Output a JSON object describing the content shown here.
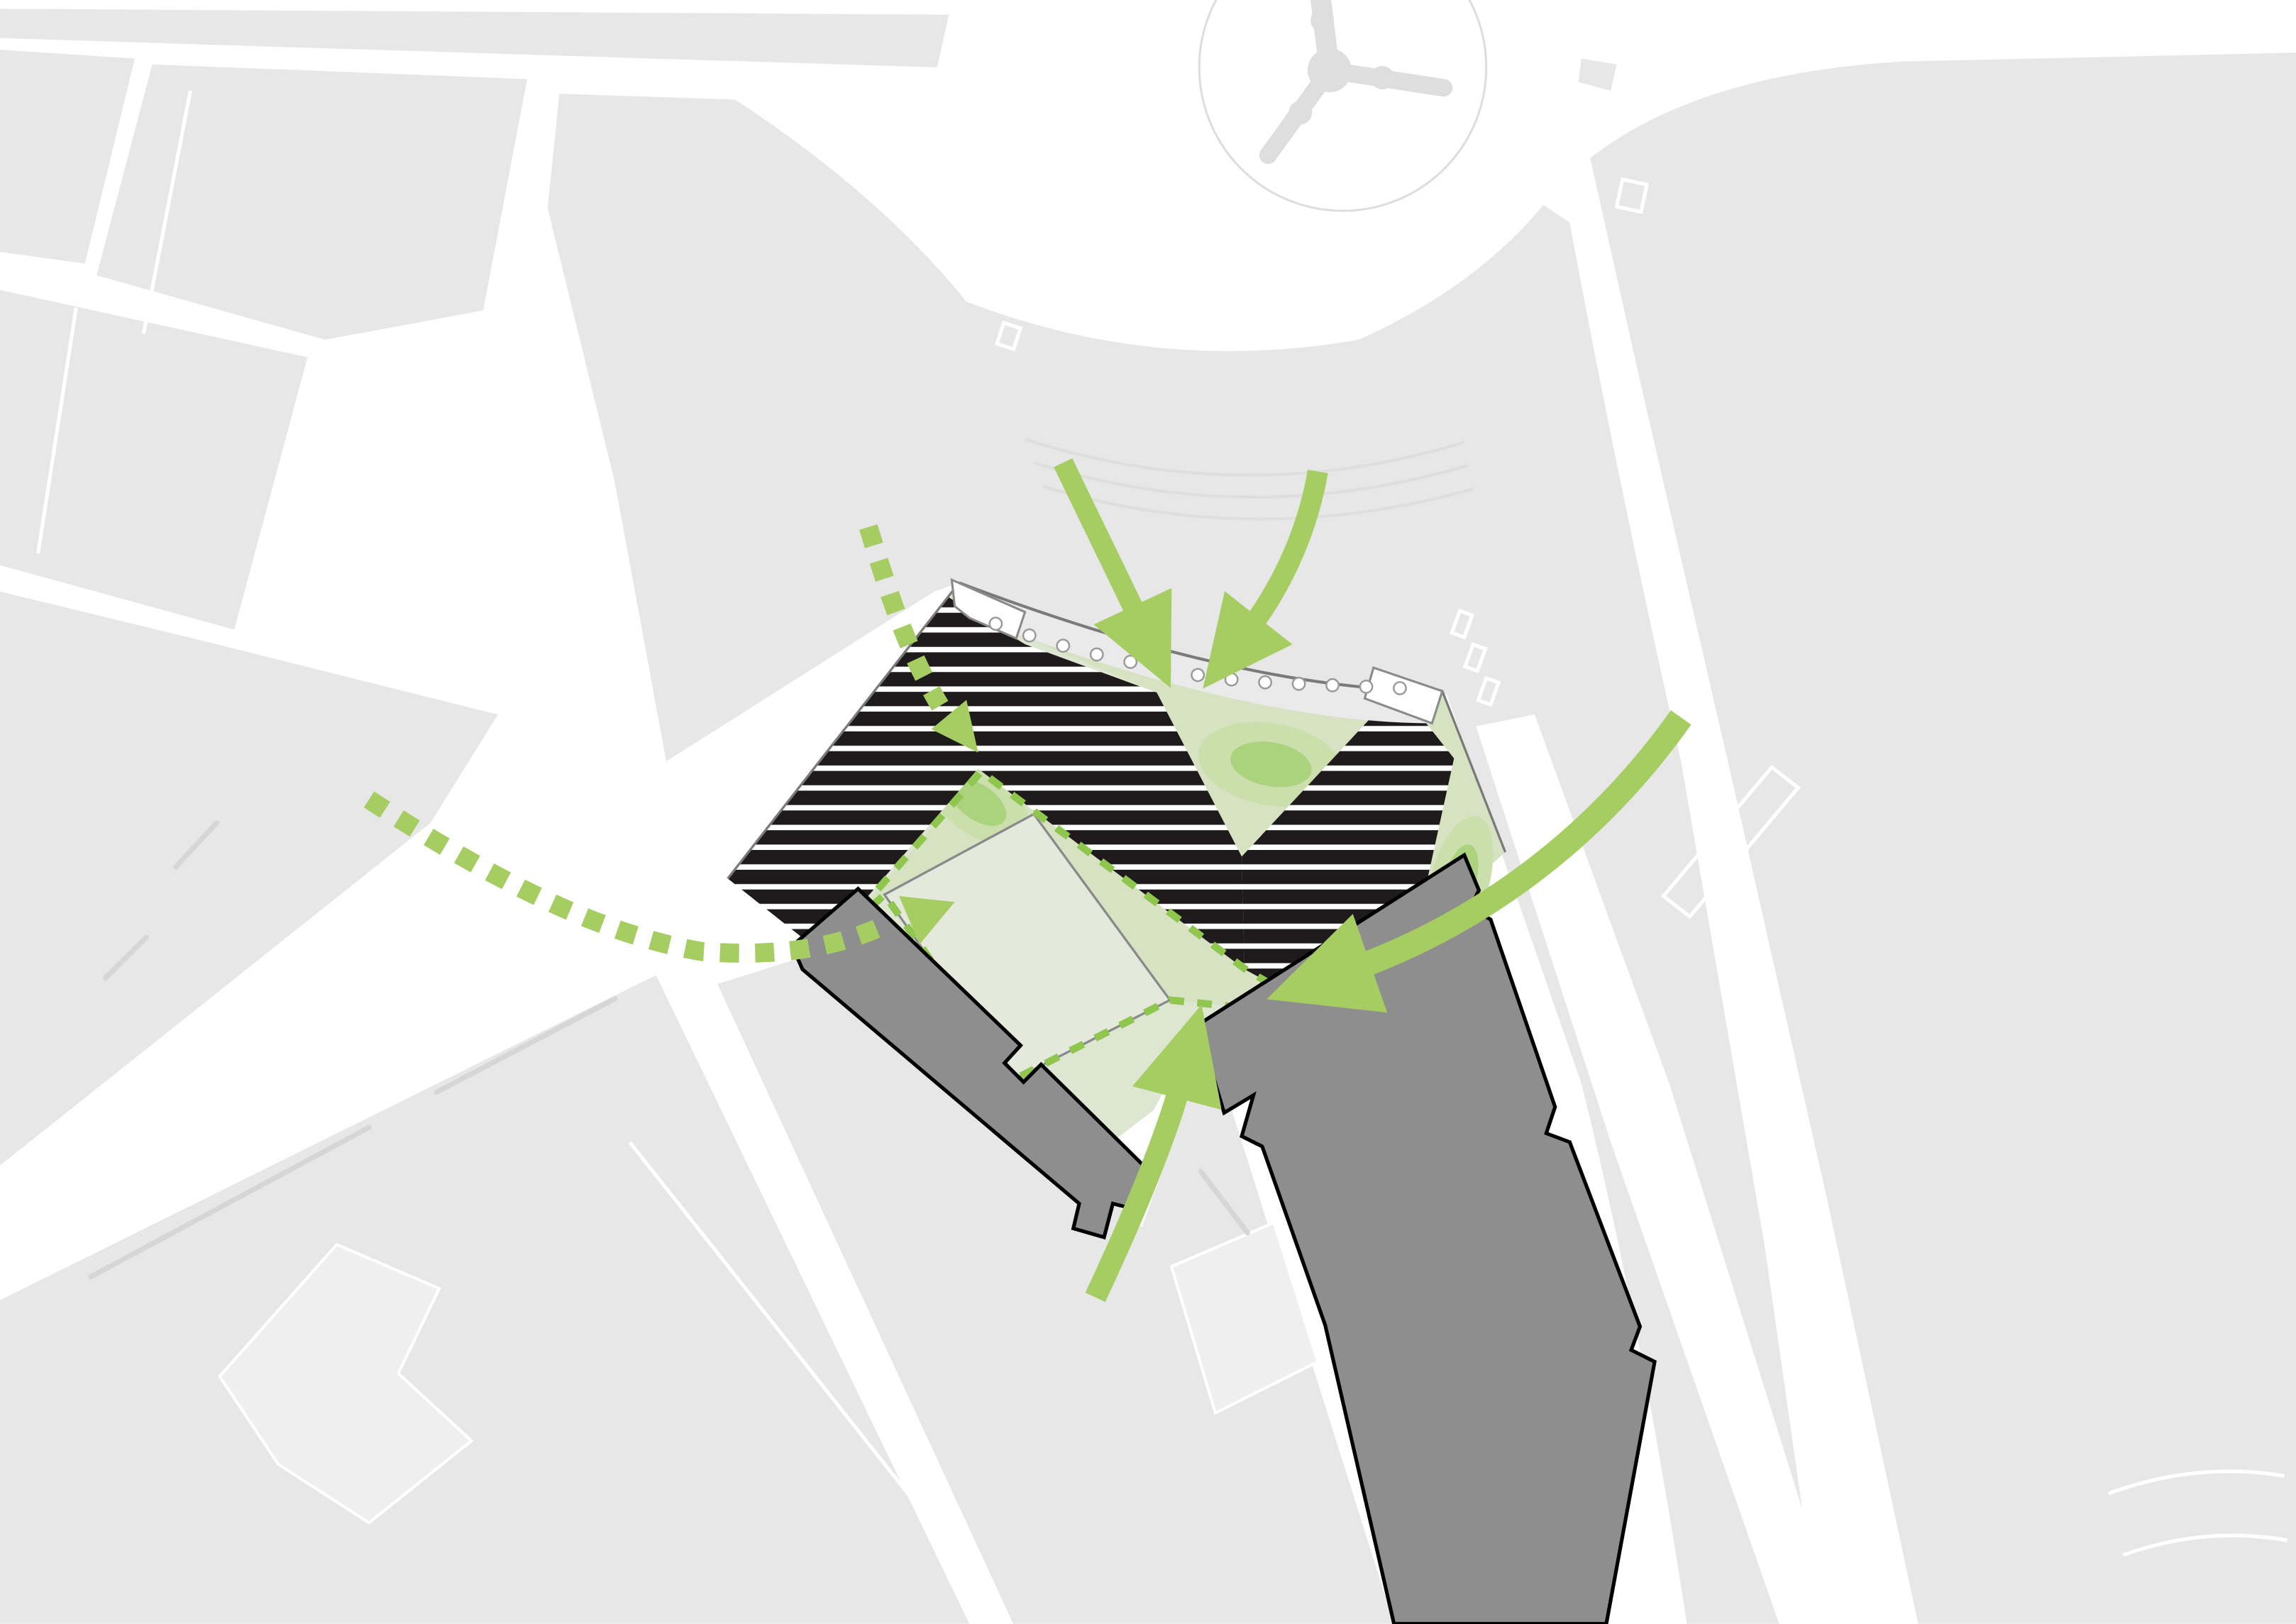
{
  "diagram": {
    "title": "Urban site plan access diagram",
    "type": "architectural-site-diagram",
    "has_visible_text": false,
    "colors": {
      "white": "#ffffff",
      "block": "#e7e7e7",
      "block-light": "#efefef",
      "lane": "#d6d6d6",
      "outline-faint": "#dedede",
      "boundary": "#7a7a7a",
      "site-green": "#dde6d0",
      "valley-green": "#d6e2c2",
      "mound1": "#cbdfad",
      "mound2": "#abd37e",
      "square": "#e4e9dc",
      "square-stroke": "#8a8a8a",
      "black": "#1f1b1c",
      "bldg-gray": "#8e8e8e",
      "bldg-stroke": "#000000",
      "arrow": "#a5cd62",
      "dash": "#8fc64e",
      "strip": "#eaeaea",
      "tripod": "#dedede"
    },
    "elements": {
      "context": [
        "light-gray city blocks",
        "white streets",
        "thin gray lane markings",
        "roundabout with three-armed junction figure"
      ],
      "site": {
        "black_building": "chevron / zigzag striped building made of horizontal black bars (two folded wings)",
        "stripe_count_approx": 22,
        "green_courtyards": 3,
        "mounds": 3,
        "tree_circles_on_strip": 13,
        "dashed_outline": "green dashed boundary around inner courtyard and future plot",
        "pale_square": "rotated square plot outlined gray"
      },
      "buildings": [
        "small dark-gray slab south-west of site",
        "large dark-gray tower slab south-east of site"
      ],
      "arrows": [
        {
          "name": "top-left-curved-arrow",
          "direction": "from north curving down into site"
        },
        {
          "name": "top-right-curved-arrow",
          "direction": "from north-east curving down into site"
        },
        {
          "name": "east-large-curved-arrow",
          "direction": "from east sweeping west over tower into courtyard"
        },
        {
          "name": "south-curved-arrow",
          "direction": "from south curving up between buildings"
        },
        {
          "name": "west-dashed-arrow-upper",
          "direction": "dotted trail from north-west into upper courtyard"
        },
        {
          "name": "west-dashed-arrow-lower",
          "direction": "dotted trail from west boulevard into square plot"
        }
      ]
    }
  }
}
